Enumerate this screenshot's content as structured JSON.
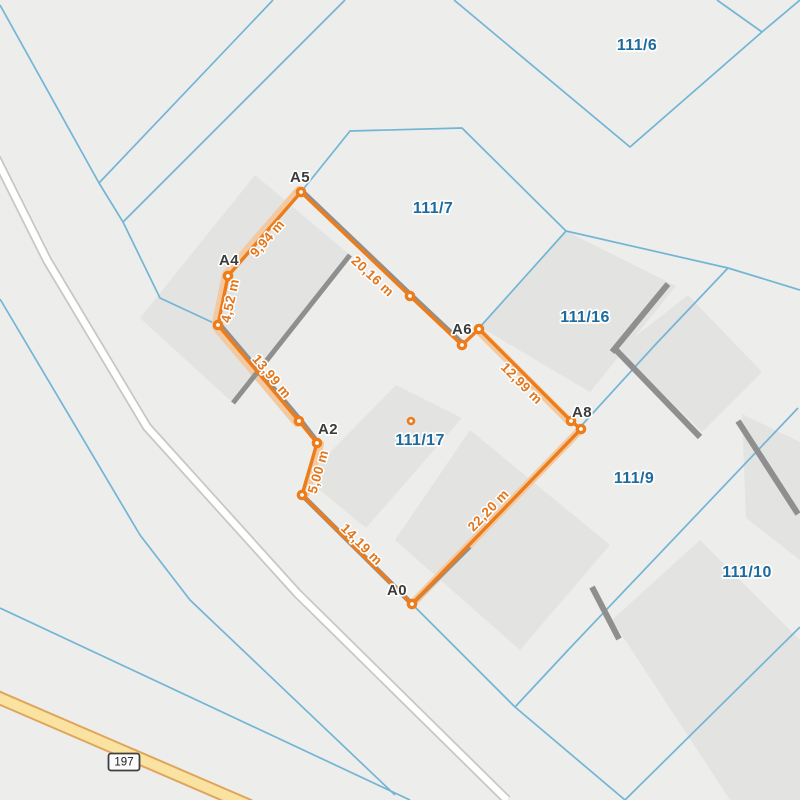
{
  "map": {
    "size": 800,
    "colors": {
      "background": "#EDEDEB",
      "building_fill": "#E3E3E1",
      "wall_gray": "#8F8F8F",
      "boundary_blue": "#72B5D5",
      "highlight_peach": "#F3C9A1",
      "measure_orange": "#ED7C1B",
      "measure_label_orange": "#E2761B",
      "parcel_label_blue": "#1D6A9E",
      "vertex_label_gray": "#3B3B3B",
      "road_fill_white": "#FFFFFF",
      "road_casing_gray": "#C7C7C5",
      "highway_fill_yellow": "#FAE3A0",
      "highway_casing_orange": "#E0A55C",
      "label_halo": "#FFFFFF"
    },
    "parcel_labels": [
      {
        "id": "111/6",
        "x": 637,
        "y": 46
      },
      {
        "id": "111/7",
        "x": 433,
        "y": 209
      },
      {
        "id": "111/16",
        "x": 585,
        "y": 318
      },
      {
        "id": "111/17",
        "x": 420,
        "y": 441
      },
      {
        "id": "111/9",
        "x": 634,
        "y": 479
      },
      {
        "id": "111/10",
        "x": 747,
        "y": 573
      }
    ],
    "boundaries": [
      {
        "points": [
          [
            0,
            5
          ],
          [
            99,
            183
          ],
          [
            123,
            222
          ],
          [
            160,
            298
          ],
          [
            218,
            325
          ]
        ]
      },
      {
        "points": [
          [
            99,
            183
          ],
          [
            273,
            0
          ]
        ]
      },
      {
        "points": [
          [
            123,
            222
          ],
          [
            345,
            0
          ]
        ]
      },
      {
        "points": [
          [
            301,
            192
          ],
          [
            350,
            131
          ],
          [
            462,
            128
          ],
          [
            566,
            231
          ]
        ]
      },
      {
        "points": [
          [
            566,
            231
          ],
          [
            480,
            327
          ]
        ]
      },
      {
        "points": [
          [
            566,
            231
          ],
          [
            728,
            268
          ],
          [
            800,
            290
          ]
        ]
      },
      {
        "points": [
          [
            728,
            268
          ],
          [
            655,
            345
          ],
          [
            582,
            425
          ]
        ]
      },
      {
        "points": [
          [
            412,
            604
          ],
          [
            302,
            495
          ],
          [
            317,
            443
          ],
          [
            299,
            421
          ],
          [
            218,
            325
          ],
          [
            228,
            276
          ],
          [
            301,
            192
          ],
          [
            410,
            296
          ],
          [
            462,
            345
          ],
          [
            479,
            329
          ],
          [
            571,
            421
          ],
          [
            581,
            429
          ],
          [
            412,
            604
          ]
        ]
      },
      {
        "points": [
          [
            412,
            604
          ],
          [
            515,
            707
          ]
        ]
      },
      {
        "points": [
          [
            515,
            707
          ],
          [
            570,
            648
          ],
          [
            798,
            408
          ]
        ]
      },
      {
        "points": [
          [
            515,
            707
          ],
          [
            625,
            800
          ]
        ]
      },
      {
        "points": [
          [
            625,
            800
          ],
          [
            800,
            627
          ]
        ]
      },
      {
        "points": [
          [
            454,
            0
          ],
          [
            630,
            147
          ],
          [
            762,
            32
          ]
        ]
      },
      {
        "points": [
          [
            762,
            32
          ],
          [
            717,
            0
          ]
        ]
      },
      {
        "points": [
          [
            762,
            32
          ],
          [
            800,
            0
          ]
        ]
      },
      {
        "points": [
          [
            0,
            299
          ],
          [
            140,
            535
          ],
          [
            190,
            600
          ],
          [
            395,
            795
          ]
        ]
      },
      {
        "points": [
          [
            0,
            608
          ],
          [
            410,
            800
          ]
        ]
      }
    ],
    "buildings": [
      {
        "polygon": [
          [
            255,
            175
          ],
          [
            350,
            255
          ],
          [
            233,
            403
          ],
          [
            140,
            318
          ]
        ]
      },
      {
        "polygon": [
          [
            396,
            385
          ],
          [
            462,
            418
          ],
          [
            366,
            528
          ],
          [
            305,
            478
          ]
        ]
      },
      {
        "polygon": [
          [
            470,
            430
          ],
          [
            610,
            545
          ],
          [
            520,
            650
          ],
          [
            395,
            540
          ]
        ]
      },
      {
        "polygon": [
          [
            566,
            231
          ],
          [
            676,
            286
          ],
          [
            590,
            392
          ],
          [
            480,
            327
          ]
        ]
      },
      {
        "polygon": [
          [
            688,
            295
          ],
          [
            762,
            372
          ],
          [
            702,
            432
          ],
          [
            618,
            350
          ]
        ]
      },
      {
        "polygon": [
          [
            742,
            414
          ],
          [
            800,
            442
          ],
          [
            800,
            560
          ],
          [
            746,
            518
          ]
        ]
      },
      {
        "polygon": [
          [
            612,
            620
          ],
          [
            700,
            540
          ],
          [
            800,
            640
          ],
          [
            800,
            800
          ],
          [
            730,
            800
          ]
        ]
      }
    ],
    "walls": [
      {
        "points": [
          [
            350,
            255
          ],
          [
            233,
            403
          ]
        ],
        "w": 5
      },
      {
        "points": [
          [
            220,
            324
          ],
          [
            301,
            420
          ],
          [
            318,
            442
          ]
        ],
        "w": 4
      },
      {
        "points": [
          [
            668,
            284
          ],
          [
            612,
            352
          ]
        ],
        "w": 6
      },
      {
        "points": [
          [
            301,
            190
          ],
          [
            410,
            294
          ],
          [
            462,
            343
          ]
        ],
        "w": 5
      },
      {
        "points": [
          [
            302,
            495
          ],
          [
            412,
            604
          ]
        ],
        "w": 5
      },
      {
        "points": [
          [
            412,
            604
          ],
          [
            470,
            547
          ]
        ],
        "w": 4
      },
      {
        "points": [
          [
            738,
            421
          ],
          [
            798,
            514
          ]
        ],
        "w": 6
      },
      {
        "points": [
          [
            592,
            587
          ],
          [
            619,
            639
          ]
        ],
        "w": 6
      },
      {
        "points": [
          [
            616,
            350
          ],
          [
            700,
            437
          ]
        ],
        "w": 6
      }
    ],
    "roads": {
      "minor_road": {
        "points": [
          [
            -4,
            158
          ],
          [
            47,
            260
          ],
          [
            147,
            427
          ],
          [
            297,
            593
          ],
          [
            507,
            800
          ]
        ],
        "casing_w": 10,
        "fill_w": 6.5
      },
      "highway": {
        "points": [
          [
            -10,
            694
          ],
          [
            120,
            750
          ],
          [
            250,
            806
          ]
        ],
        "casing_w": 14,
        "fill_w": 10
      }
    },
    "road_shield": {
      "label": "197",
      "x": 124,
      "y": 762
    },
    "measurement": {
      "vertices": [
        {
          "x": 412,
          "y": 604,
          "label": "A0",
          "lx": 397,
          "ly": 591
        },
        {
          "x": 302,
          "y": 495,
          "label": null
        },
        {
          "x": 317,
          "y": 443,
          "label": "A2",
          "lx": 328,
          "ly": 430
        },
        {
          "x": 299,
          "y": 421,
          "label": null
        },
        {
          "x": 218,
          "y": 325,
          "label": null
        },
        {
          "x": 228,
          "y": 276,
          "label": "A4",
          "lx": 229,
          "ly": 261
        },
        {
          "x": 301,
          "y": 192,
          "label": "A5",
          "lx": 300,
          "ly": 178
        },
        {
          "x": 410,
          "y": 296,
          "label": null
        },
        {
          "x": 462,
          "y": 345,
          "label": null
        },
        {
          "x": 479,
          "y": 329,
          "label": "A6",
          "lx": 462,
          "ly": 330
        },
        {
          "x": 571,
          "y": 421,
          "label": null
        },
        {
          "x": 581,
          "y": 429,
          "label": "A8",
          "lx": 582,
          "ly": 413
        }
      ],
      "closed": true,
      "highlights": [
        {
          "points": [
            [
              216,
              323
            ],
            [
              226,
              274
            ],
            [
              299,
              190
            ]
          ]
        },
        {
          "points": [
            [
              216,
              327
            ],
            [
              297,
              423
            ]
          ]
        },
        {
          "points": [
            [
              478,
              330
            ],
            [
              570,
              422
            ]
          ]
        },
        {
          "points": [
            [
              412,
              604
            ],
            [
              581,
              429
            ]
          ]
        },
        {
          "points": [
            [
              320,
              444
            ],
            [
              306,
              493
            ]
          ]
        }
      ],
      "distance_labels": [
        {
          "text": "14,19 m",
          "x": 361,
          "y": 545,
          "angle": 45
        },
        {
          "text": "5,00 m",
          "x": 319,
          "y": 472,
          "angle": -74
        },
        {
          "text": "13,99 m",
          "x": 271,
          "y": 377,
          "angle": 50
        },
        {
          "text": "4,52 m",
          "x": 231,
          "y": 301,
          "angle": -78
        },
        {
          "text": "9,94 m",
          "x": 268,
          "y": 239,
          "angle": -49
        },
        {
          "text": "20,16 m",
          "x": 372,
          "y": 277,
          "angle": 43
        },
        {
          "text": "12,99 m",
          "x": 521,
          "y": 384,
          "angle": 45
        },
        {
          "text": "22,20 m",
          "x": 489,
          "y": 511,
          "angle": -46
        }
      ],
      "area_marker": {
        "x": 411,
        "y": 421
      }
    }
  }
}
